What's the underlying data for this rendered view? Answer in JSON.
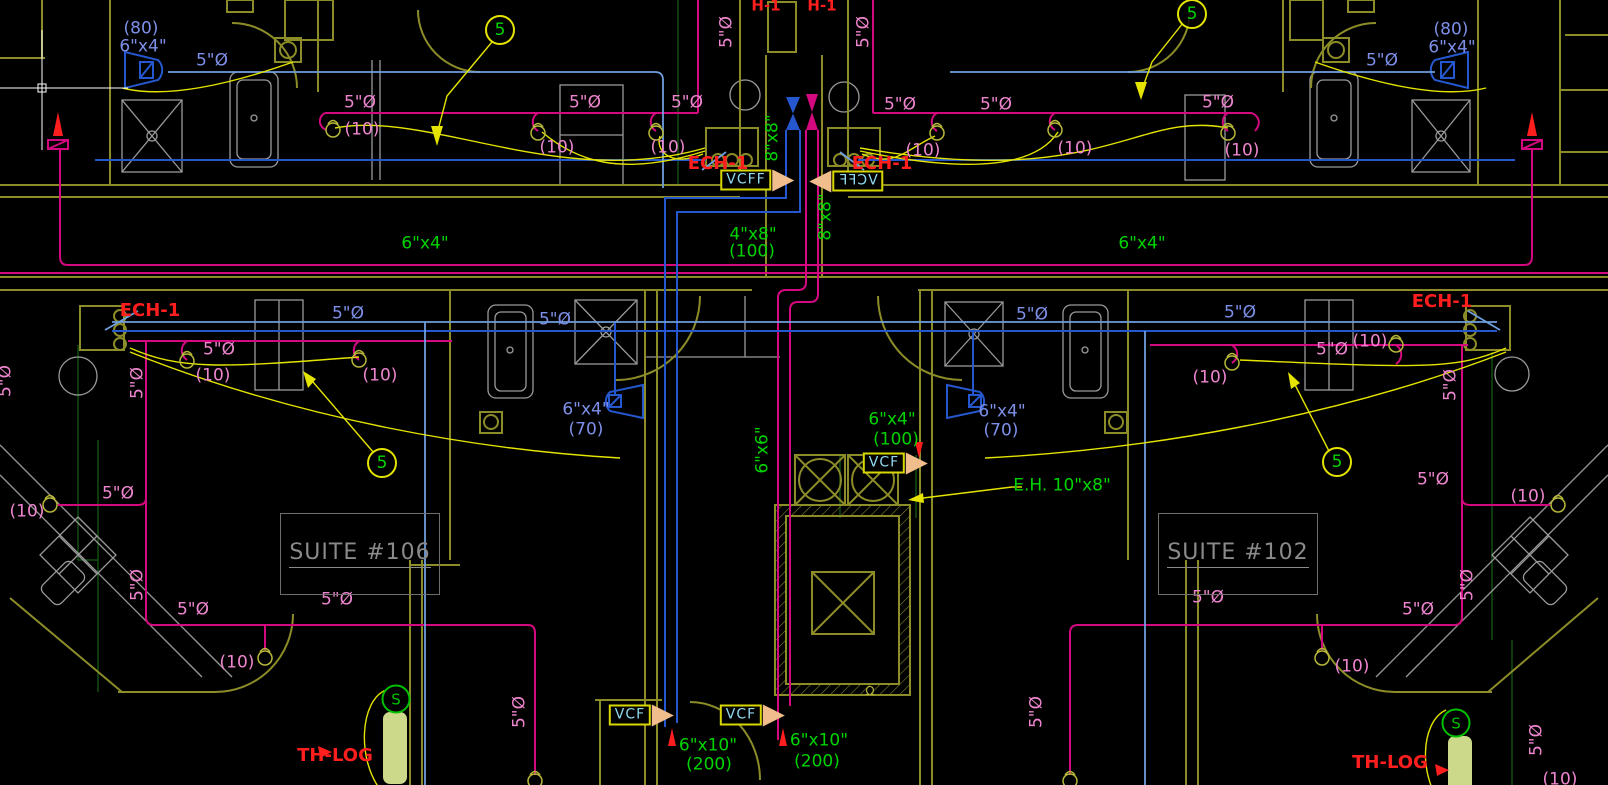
{
  "drawing": {
    "kind": "HVAC floor plan"
  },
  "colors": {
    "background": "#000000",
    "olive": "#8c8c28",
    "olive_bright": "#b8b83a",
    "gray": "#9a9a9a",
    "blue": "#2558cf",
    "blue_light": "#6f9ede",
    "blue_text": "#7d8fe8",
    "pink_line": "#d40980",
    "pink": "#ee85cf",
    "green": "#00d400",
    "green_dark": "#124f12",
    "yellow": "#e4e400",
    "red": "#ff1e1e",
    "cyan": "#8fd8ef",
    "orange": "#f2bd8d",
    "pale": "#ccd98a",
    "suite_gray": "#8a8a8a",
    "white": "#ffffff"
  },
  "labels": [
    {
      "t": "(80)",
      "x": 141,
      "y": 29,
      "c": "blue_text",
      "n": "airflow-label"
    },
    {
      "t": "6\"x4\"",
      "x": 143,
      "y": 47,
      "c": "blue_text",
      "n": "duct-size-label"
    },
    {
      "t": "5\"Ø",
      "x": 212,
      "y": 61,
      "c": "blue_text",
      "n": "diameter-label"
    },
    {
      "t": "(80)",
      "x": 1451,
      "y": 30,
      "c": "blue_text",
      "n": "airflow-label"
    },
    {
      "t": "6\"x4\"",
      "x": 1452,
      "y": 48,
      "c": "blue_text",
      "n": "duct-size-label"
    },
    {
      "t": "5\"Ø",
      "x": 1382,
      "y": 61,
      "c": "blue_text",
      "n": "diameter-label"
    },
    {
      "t": "5\"Ø",
      "x": 348,
      "y": 314,
      "c": "blue_text",
      "n": "diameter-label"
    },
    {
      "t": "5\"Ø",
      "x": 555,
      "y": 320,
      "c": "blue_text",
      "n": "diameter-label"
    },
    {
      "t": "5\"Ø",
      "x": 1032,
      "y": 315,
      "c": "blue_text",
      "n": "diameter-label"
    },
    {
      "t": "5\"Ø",
      "x": 1240,
      "y": 313,
      "c": "blue_text",
      "n": "diameter-label"
    },
    {
      "t": "6\"x4\"",
      "x": 586,
      "y": 410,
      "c": "blue_text",
      "n": "duct-size-label"
    },
    {
      "t": "(70)",
      "x": 586,
      "y": 430,
      "c": "blue_text",
      "n": "airflow-label"
    },
    {
      "t": "6\"x4\"",
      "x": 1002,
      "y": 412,
      "c": "blue_text",
      "n": "duct-size-label"
    },
    {
      "t": "(70)",
      "x": 1001,
      "y": 431,
      "c": "blue_text",
      "n": "airflow-label"
    },
    {
      "t": "5\"Ø",
      "x": 360,
      "y": 103,
      "c": "pink",
      "n": "diameter-label"
    },
    {
      "t": "5\"Ø",
      "x": 585,
      "y": 103,
      "c": "pink",
      "n": "diameter-label"
    },
    {
      "t": "5\"Ø",
      "x": 687,
      "y": 103,
      "c": "pink",
      "n": "diameter-label"
    },
    {
      "t": "5\"Ø",
      "x": 900,
      "y": 105,
      "c": "pink",
      "n": "diameter-label"
    },
    {
      "t": "5\"Ø",
      "x": 996,
      "y": 105,
      "c": "pink",
      "n": "diameter-label"
    },
    {
      "t": "5\"Ø",
      "x": 1218,
      "y": 103,
      "c": "pink",
      "n": "diameter-label"
    },
    {
      "t": "(10)",
      "x": 362,
      "y": 130,
      "c": "pink",
      "n": "airflow-label"
    },
    {
      "t": "(10)",
      "x": 557,
      "y": 148,
      "c": "pink",
      "n": "airflow-label"
    },
    {
      "t": "(10)",
      "x": 668,
      "y": 148,
      "c": "pink",
      "n": "airflow-label"
    },
    {
      "t": "(10)",
      "x": 923,
      "y": 151,
      "c": "pink",
      "n": "airflow-label"
    },
    {
      "t": "(10)",
      "x": 1075,
      "y": 149,
      "c": "pink",
      "n": "airflow-label"
    },
    {
      "t": "(10)",
      "x": 1242,
      "y": 151,
      "c": "pink",
      "n": "airflow-label"
    },
    {
      "t": "5\"Ø",
      "x": 727,
      "y": 32,
      "c": "pink",
      "r": -90,
      "n": "diameter-label"
    },
    {
      "t": "5\"Ø",
      "x": 864,
      "y": 32,
      "c": "pink",
      "r": -90,
      "n": "diameter-label"
    },
    {
      "t": "5\"Ø",
      "x": 219,
      "y": 350,
      "c": "pink",
      "n": "diameter-label"
    },
    {
      "t": "(10)",
      "x": 213,
      "y": 376,
      "c": "pink",
      "n": "airflow-label"
    },
    {
      "t": "(10)",
      "x": 380,
      "y": 376,
      "c": "pink",
      "n": "airflow-label"
    },
    {
      "t": "5\"Ø",
      "x": 138,
      "y": 383,
      "c": "pink",
      "r": -90,
      "n": "diameter-label"
    },
    {
      "t": "5\"Ø",
      "x": 1332,
      "y": 350,
      "c": "pink",
      "n": "diameter-label"
    },
    {
      "t": "(10)",
      "x": 1370,
      "y": 342,
      "c": "pink",
      "n": "airflow-label"
    },
    {
      "t": "(10)",
      "x": 1210,
      "y": 378,
      "c": "pink",
      "n": "airflow-label"
    },
    {
      "t": "5\"Ø",
      "x": 1451,
      "y": 385,
      "c": "pink",
      "r": -90,
      "n": "diameter-label"
    },
    {
      "t": "(10)",
      "x": 27,
      "y": 512,
      "c": "pink",
      "n": "airflow-label"
    },
    {
      "t": "5\"Ø",
      "x": 118,
      "y": 494,
      "c": "pink",
      "n": "diameter-label"
    },
    {
      "t": "5\"Ø",
      "x": 138,
      "y": 585,
      "c": "pink",
      "r": -90,
      "n": "diameter-label"
    },
    {
      "t": "5\"Ø",
      "x": 193,
      "y": 610,
      "c": "pink",
      "n": "diameter-label"
    },
    {
      "t": "5\"Ø",
      "x": 337,
      "y": 600,
      "c": "pink",
      "n": "diameter-label"
    },
    {
      "t": "(10)",
      "x": 237,
      "y": 663,
      "c": "pink",
      "n": "airflow-label"
    },
    {
      "t": "5\"Ø",
      "x": 520,
      "y": 712,
      "c": "pink",
      "r": -90,
      "n": "diameter-label"
    },
    {
      "t": "5\"Ø",
      "x": 1037,
      "y": 712,
      "c": "pink",
      "r": -90,
      "n": "diameter-label"
    },
    {
      "t": "(10)",
      "x": 1352,
      "y": 667,
      "c": "pink",
      "n": "airflow-label"
    },
    {
      "t": "5\"Ø",
      "x": 1208,
      "y": 598,
      "c": "pink",
      "n": "diameter-label"
    },
    {
      "t": "5\"Ø",
      "x": 1418,
      "y": 610,
      "c": "pink",
      "n": "diameter-label"
    },
    {
      "t": "5\"Ø",
      "x": 1468,
      "y": 585,
      "c": "pink",
      "r": -90,
      "n": "diameter-label"
    },
    {
      "t": "5\"Ø",
      "x": 1433,
      "y": 480,
      "c": "pink",
      "n": "diameter-label"
    },
    {
      "t": "(10)",
      "x": 1528,
      "y": 497,
      "c": "pink",
      "n": "airflow-label"
    },
    {
      "t": "5\"Ø",
      "x": 1537,
      "y": 740,
      "c": "pink",
      "r": -90,
      "n": "diameter-label"
    },
    {
      "t": "(10)",
      "x": 1560,
      "y": 780,
      "c": "pink",
      "n": "airflow-label"
    },
    {
      "t": "5\"Ø",
      "x": 6,
      "y": 381,
      "c": "pink",
      "r": -90,
      "n": "diameter-label"
    },
    {
      "t": "8\"x8\"",
      "x": 773,
      "y": 138,
      "c": "green",
      "r": -90,
      "n": "duct-size-label"
    },
    {
      "t": "8\"x8\"",
      "x": 826,
      "y": 217,
      "c": "green",
      "r": -90,
      "n": "duct-size-label"
    },
    {
      "t": "4\"x8\"",
      "x": 753,
      "y": 235,
      "c": "green",
      "n": "duct-size-label"
    },
    {
      "t": "(100)",
      "x": 752,
      "y": 252,
      "c": "green",
      "n": "airflow-label"
    },
    {
      "t": "6\"x4\"",
      "x": 425,
      "y": 244,
      "c": "green",
      "n": "duct-size-label"
    },
    {
      "t": "6\"x4\"",
      "x": 1142,
      "y": 244,
      "c": "green",
      "n": "duct-size-label"
    },
    {
      "t": "6\"x4\"",
      "x": 892,
      "y": 420,
      "c": "green",
      "n": "duct-size-label"
    },
    {
      "t": "(100)",
      "x": 896,
      "y": 440,
      "c": "green",
      "n": "airflow-label"
    },
    {
      "t": "E.H. 10\"x8\"",
      "x": 1062,
      "y": 486,
      "c": "green",
      "n": "electric-heater-label"
    },
    {
      "t": "6\"x6\"",
      "x": 763,
      "y": 450,
      "c": "green",
      "r": -90,
      "n": "duct-size-label"
    },
    {
      "t": "6\"x10\"",
      "x": 708,
      "y": 746,
      "c": "green",
      "n": "duct-size-label"
    },
    {
      "t": "(200)",
      "x": 709,
      "y": 765,
      "c": "green",
      "n": "airflow-label"
    },
    {
      "t": "6\"x10\"",
      "x": 819,
      "y": 741,
      "c": "green",
      "n": "duct-size-label"
    },
    {
      "t": "(200)",
      "x": 817,
      "y": 762,
      "c": "green",
      "n": "airflow-label"
    },
    {
      "t": "H-1",
      "x": 766,
      "y": 6,
      "c": "red",
      "s": 15,
      "b": true,
      "n": "equipment-tag"
    },
    {
      "t": "H-1",
      "x": 822,
      "y": 6,
      "c": "red",
      "s": 15,
      "b": true,
      "n": "equipment-tag"
    },
    {
      "t": "ECH-1",
      "x": 718,
      "y": 164,
      "c": "red",
      "s": 18,
      "b": true,
      "n": "equipment-tag"
    },
    {
      "t": "ECH-1",
      "x": 882,
      "y": 164,
      "c": "red",
      "s": 18,
      "b": true,
      "n": "equipment-tag"
    },
    {
      "t": "ECH-1",
      "x": 150,
      "y": 311,
      "c": "red",
      "s": 18,
      "b": true,
      "n": "equipment-tag"
    },
    {
      "t": "ECH-1",
      "x": 1442,
      "y": 302,
      "c": "red",
      "s": 18,
      "b": true,
      "n": "equipment-tag"
    },
    {
      "t": "TH-LOG",
      "x": 335,
      "y": 756,
      "c": "red",
      "s": 18,
      "b": true,
      "n": "thermostat-tag"
    },
    {
      "t": "TH-LOG",
      "x": 1390,
      "y": 763,
      "c": "red",
      "s": 18,
      "b": true,
      "n": "thermostat-tag"
    },
    {
      "t": "Ω",
      "x": 870,
      "y": 691,
      "c": "olive_bright",
      "s": 12,
      "n": "door-symbol"
    }
  ],
  "balloons": [
    {
      "num": "5",
      "x": 500,
      "y": 30
    },
    {
      "num": "5",
      "x": 1192,
      "y": 14
    },
    {
      "num": "5",
      "x": 382,
      "y": 463
    },
    {
      "num": "5",
      "x": 1337,
      "y": 462
    }
  ],
  "flag_boxes": [
    {
      "label": "VCFF",
      "x": 746,
      "y": 180,
      "tri": "right",
      "mirrored": false
    },
    {
      "label": "VCFF",
      "x": 858,
      "y": 181,
      "tri": "left",
      "mirrored": true
    },
    {
      "label": "VCF",
      "x": 884,
      "y": 463,
      "tri": "right",
      "mirrored": false
    },
    {
      "label": "VCF",
      "x": 630,
      "y": 715,
      "tri": "right",
      "mirrored": false
    },
    {
      "label": "VCF",
      "x": 741,
      "y": 715,
      "tri": "right",
      "mirrored": false
    }
  ],
  "suites": [
    {
      "label": "SUITE #106",
      "x": 280,
      "y": 513,
      "w": 158,
      "h": 80
    },
    {
      "label": "SUITE #102",
      "x": 1158,
      "y": 513,
      "w": 158,
      "h": 80
    }
  ],
  "stat_devices": [
    {
      "letter": "S",
      "x": 396,
      "y": 699
    },
    {
      "letter": "S",
      "x": 1456,
      "y": 723
    }
  ],
  "diffusers": [
    [
      333,
      130
    ],
    [
      538,
      133
    ],
    [
      656,
      133
    ],
    [
      937,
      133
    ],
    [
      1055,
      130
    ],
    [
      1228,
      133
    ],
    [
      187,
      361
    ],
    [
      359,
      360
    ],
    [
      1232,
      363
    ],
    [
      1396,
      345
    ],
    [
      50,
      505
    ],
    [
      1558,
      505
    ],
    [
      265,
      658
    ],
    [
      1322,
      658
    ],
    [
      535,
      781
    ],
    [
      1070,
      781
    ]
  ]
}
